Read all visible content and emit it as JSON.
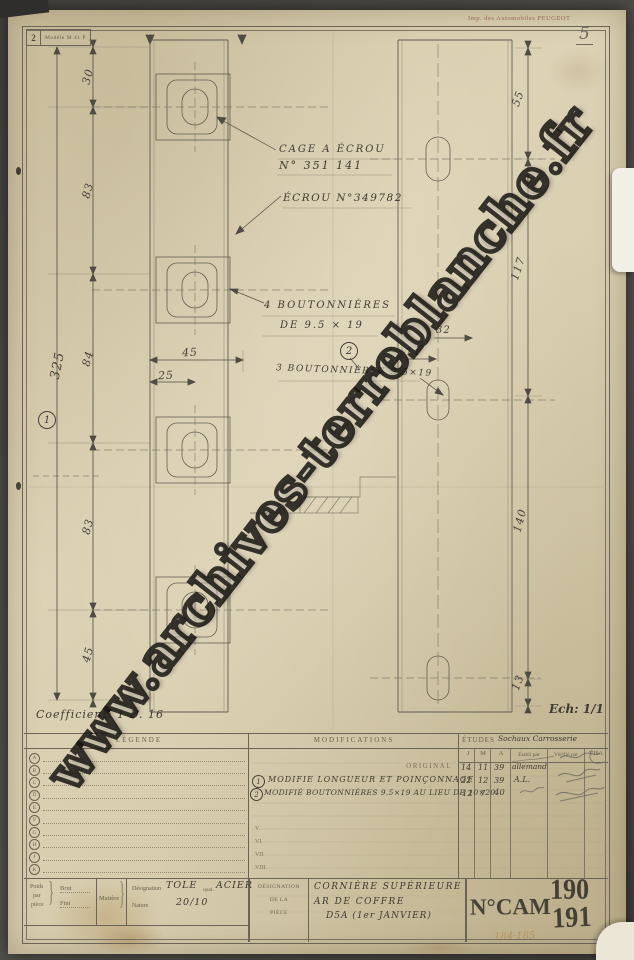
{
  "scan": {
    "page_number": "5",
    "pencil_note": "184·185"
  },
  "stamp_box": {
    "number": "2",
    "model": "Modèle M 41 P"
  },
  "printer_credit": "Imp. des Automobiles PEUGEOT",
  "watermark": {
    "text": "www.archives-terreblanche.fr"
  },
  "notes": {
    "coefficient": "Coefficient: 1 D. 16",
    "scale": "Ech: 1/1"
  },
  "annotations": {
    "cage_line1": "CAGE A ÉCROU",
    "cage_line2": "N° 351 141",
    "ecrou": "ÉCROU N°349782",
    "bout4_line1": "4 BOUTONNIÈRES",
    "bout4_line2": "DE 9.5 × 19",
    "bout3": "3 BOUTONNIÈRES 9.5×19",
    "marker_1": "1",
    "marker_2": "2"
  },
  "dimensions": {
    "left_total": "325",
    "left_chain": [
      "30",
      "83",
      "84",
      "83",
      "45"
    ],
    "width_outer": "45",
    "width_inner": "25",
    "right_chain": [
      "55",
      "117",
      "140",
      "13"
    ],
    "right_width": "32",
    "right_offset": "14"
  },
  "table": {
    "legend": {
      "header": "LÉGENDE",
      "letters": [
        "A",
        "B",
        "C",
        "D",
        "E",
        "F",
        "G",
        "H",
        "J",
        "K"
      ]
    },
    "modifications": {
      "header": "MODIFICATIONS",
      "original_label": "ORIGINAL",
      "rows": [
        {
          "num": "1",
          "text": "MODIFIE LONGUEUR ET POINÇONNAGE"
        },
        {
          "num": "2",
          "text": "MODIFIÉ BOUTONNIÈRES 9.5×19 AU LIEU DE 10×20"
        }
      ],
      "roman_rows": [
        "V",
        "VI",
        "VII",
        "VIII"
      ]
    },
    "etudes": {
      "header": "ÉTUDES",
      "header_hand": "Sochaux Carrosserie",
      "col_j": "J",
      "col_m": "M",
      "col_a": "A",
      "col_etabli": "Établi par",
      "col_verifie": "Vérifié par",
      "col_visa": "VISA",
      "entries": [
        {
          "j": "14",
          "m": "11",
          "a": "39",
          "etabli": "allemand"
        },
        {
          "j": "22",
          "m": "12",
          "a": "39",
          "etabli": "A.L."
        },
        {
          "j": "12",
          "m": "7",
          "a": "40",
          "etabli": ""
        }
      ]
    }
  },
  "title_block": {
    "poids_l1": "Poids",
    "poids_l2": "par",
    "poids_l3": "pièce",
    "brut_label": "Brut",
    "fini_label": "Fini",
    "matiere_label": "Matière",
    "designation_label": "Désignation",
    "designation_value": "TOLE",
    "qual_label": "qual.",
    "qual_value": "ACIER",
    "nature_label": "Nature",
    "nature_value": "20/10",
    "piece_l1": "DÉSIGNATION",
    "piece_l2": "DE LA",
    "piece_l3": "PIÈCE",
    "piece_name_1": "CORNIÈRE SUPÉRIEURE",
    "piece_name_2": "AR DE COFFRE",
    "piece_name_3": "D5A (1er JANVIER)",
    "cam_label": "N°CAM",
    "cam_top": "190",
    "cam_bottom": "191"
  }
}
